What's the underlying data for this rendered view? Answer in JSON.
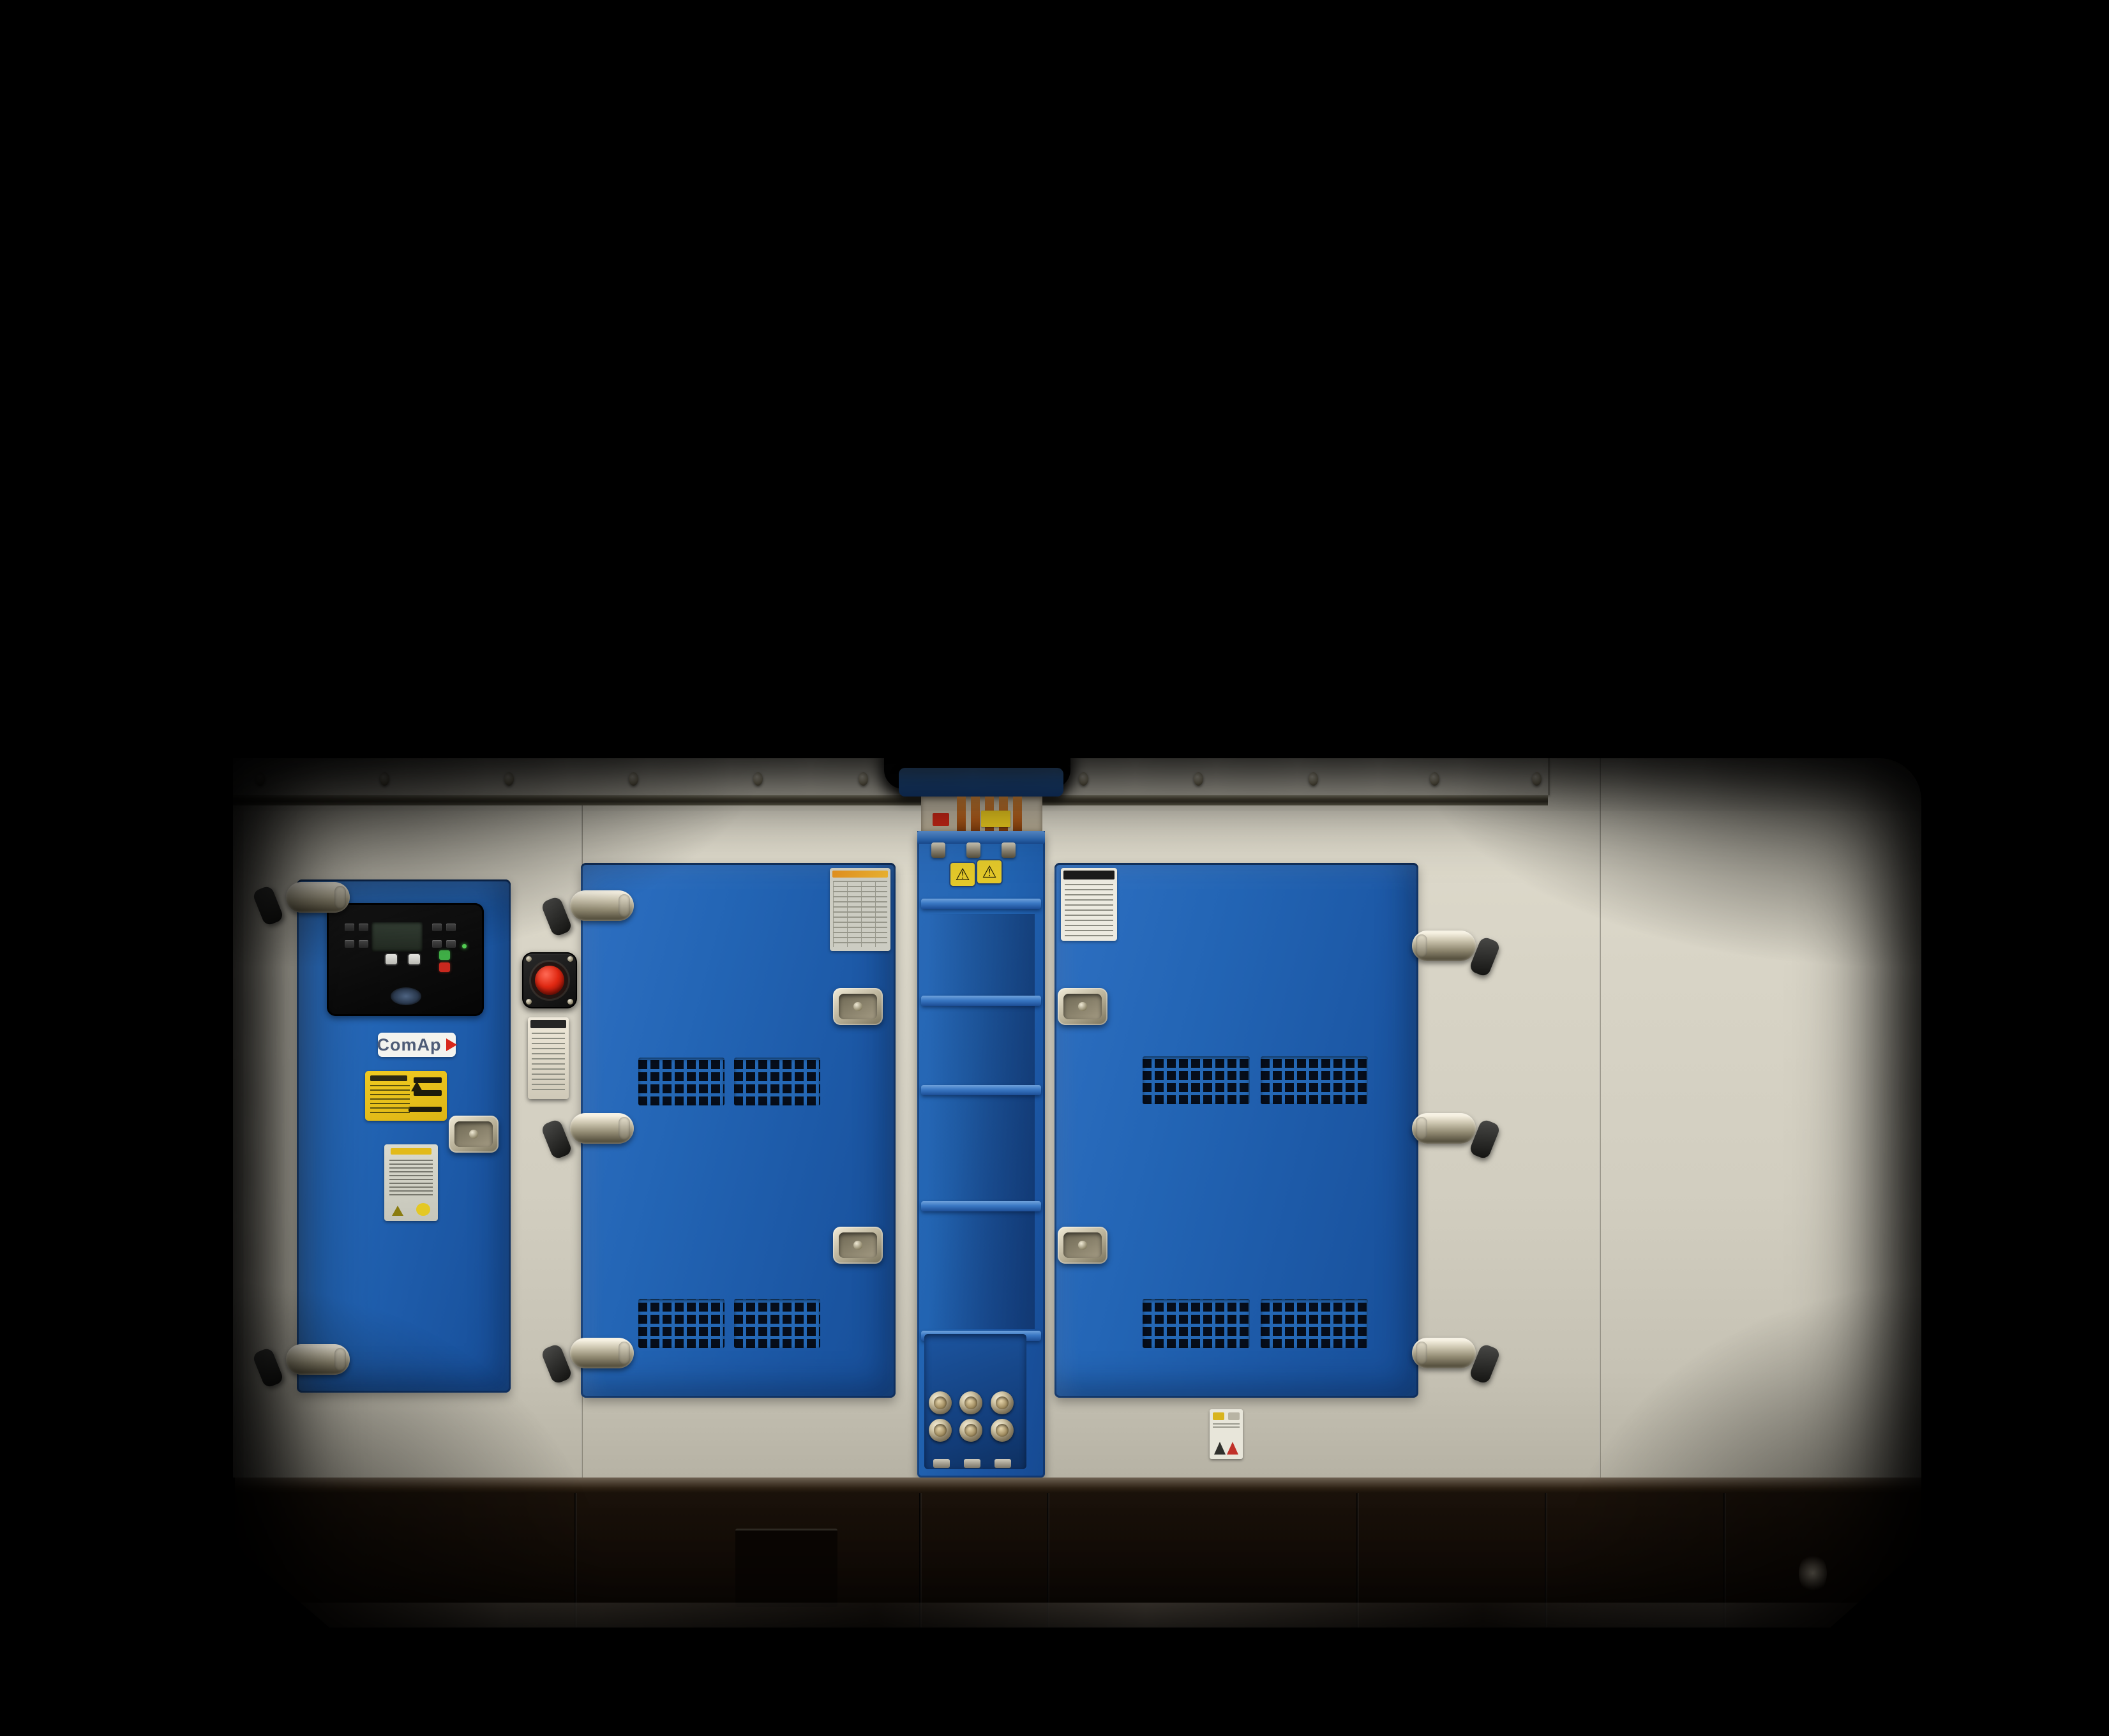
{
  "scene": {
    "type": "photograph",
    "subject": "Industrial standby diesel generator set in a soundproof canopy, front view",
    "background_color": "#000000"
  },
  "enclosure": {
    "panel_color": "#d6d2c4",
    "door_color": "#2062b2",
    "base_color": "#16100a",
    "roof_screw_count": 11,
    "sections": [
      "control-door",
      "estop-panel",
      "engine-door-left",
      "busbar-column",
      "engine-door-right",
      "side-panel",
      "end-panel"
    ]
  },
  "control_door": {
    "brand_label": "ComAp",
    "controller": {
      "display": "lcd-screen",
      "start_button_color": "#3fae46",
      "stop_button_color": "#c8281e",
      "power_led_color": "#54d154"
    },
    "stickers": [
      "yellow-warning-label",
      "white-warning-label"
    ]
  },
  "estop_panel": {
    "button_color": "#d01508",
    "housing_color": "#161616",
    "tag": "white-instruction-tag"
  },
  "busbar_column": {
    "busbar_color": "#c1702c",
    "warning_triangle": "⚠",
    "warning_triangle_count": 2,
    "cable_gland_count": 6,
    "terminal_stud_count": 3
  },
  "doors": {
    "count": 3,
    "vent_grid_count": 8,
    "latch_count": 5,
    "hinge_count": 8,
    "spec_label_count": 2
  },
  "base": {
    "type": "skid",
    "chamfered_corners": true
  }
}
